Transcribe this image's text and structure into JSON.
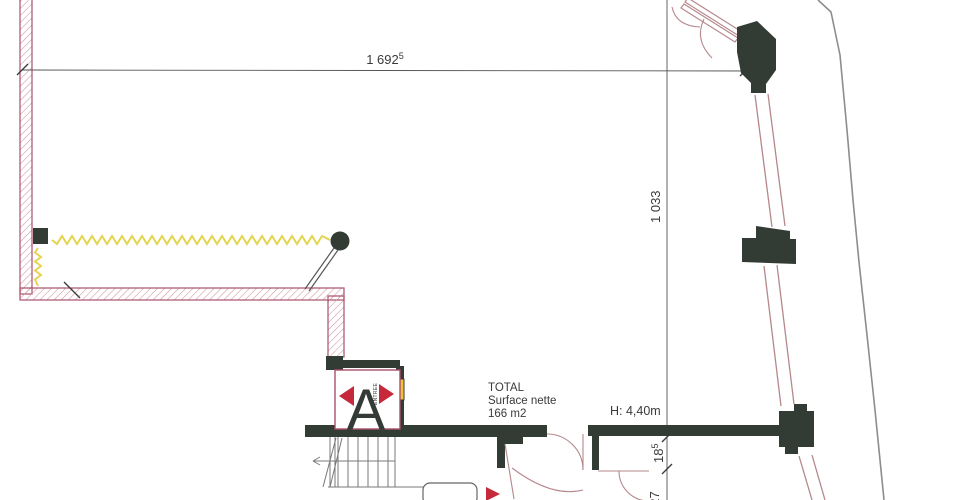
{
  "dimensions": {
    "top_width": "1 692",
    "top_width_sup": "5",
    "right_height": "1 033",
    "door_dim_1": "18",
    "door_dim_1_sup": "5",
    "door_dim_2": "227"
  },
  "labels": {
    "total": "TOTAL",
    "surface_nette": "Surface nette",
    "area": "166 m2",
    "ceiling_height": "H: 4,40m",
    "elevator_letter": "A",
    "entree": "ENTREE"
  },
  "colors": {
    "wall_dark": "#333b35",
    "wall_pink_border": "#a8506a",
    "wall_pink_hatch": "#d490a0",
    "insulation_yellow": "#e5d44e",
    "door_yellow": "#f0c335",
    "arrow_red": "#c5293a",
    "boundary_gray": "#8d8d8d",
    "dim_line": "#555555",
    "door_arc_pink": "#b5888c",
    "stair_line": "#787878",
    "text_dark": "#3a3a3a"
  }
}
